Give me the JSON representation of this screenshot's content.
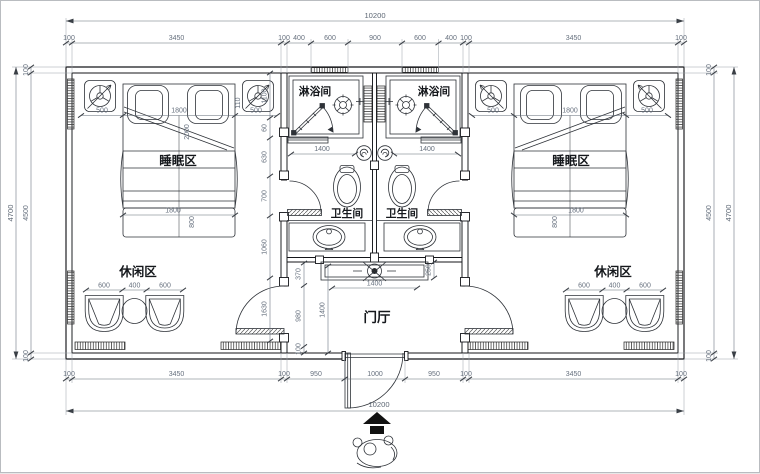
{
  "labels": {
    "sleep_left": "睡眠区",
    "sleep_right": "睡眠区",
    "leisure_left": "休闲区",
    "leisure_right": "休闲区",
    "shower_left": "淋浴间",
    "shower_right": "淋浴间",
    "wc_left": "卫生间",
    "wc_right": "卫生间",
    "hall": "门厅"
  },
  "dims": {
    "total_top": "10200",
    "total_bottom": "10200",
    "total_left": "4700",
    "total_right": "4700",
    "top_chain": [
      "100",
      "3450",
      "100",
      "400",
      "600",
      "900",
      "600",
      "400",
      "100",
      "3450",
      "100"
    ],
    "bottom_chain": [
      "100",
      "3450",
      "100",
      "950",
      "1000",
      "950",
      "100",
      "3450",
      "100"
    ],
    "left_chain": [
      "100",
      "4500",
      "100"
    ],
    "right_chain": [
      "100",
      "4500",
      "100"
    ],
    "bed_left": [
      "500",
      "1800",
      "500"
    ],
    "bed_right": [
      "500",
      "1800",
      "500"
    ],
    "bed_side": "110",
    "bed_length": "2000",
    "bench_left": [
      "1800",
      "800"
    ],
    "bench_right": [
      "1800",
      "800"
    ],
    "leisure_left": [
      "600",
      "400",
      "600"
    ],
    "leisure_right": [
      "600",
      "400",
      "600"
    ],
    "shower_width_left": "1400",
    "shower_width_right": "1400",
    "inner_chain_left": [
      "1100",
      "60",
      "630",
      "700",
      "1060",
      "1630"
    ],
    "hall_chain": [
      "370",
      "980",
      "100"
    ],
    "hall_depth": "1400",
    "console_width": "1400",
    "console_depth": "250"
  }
}
